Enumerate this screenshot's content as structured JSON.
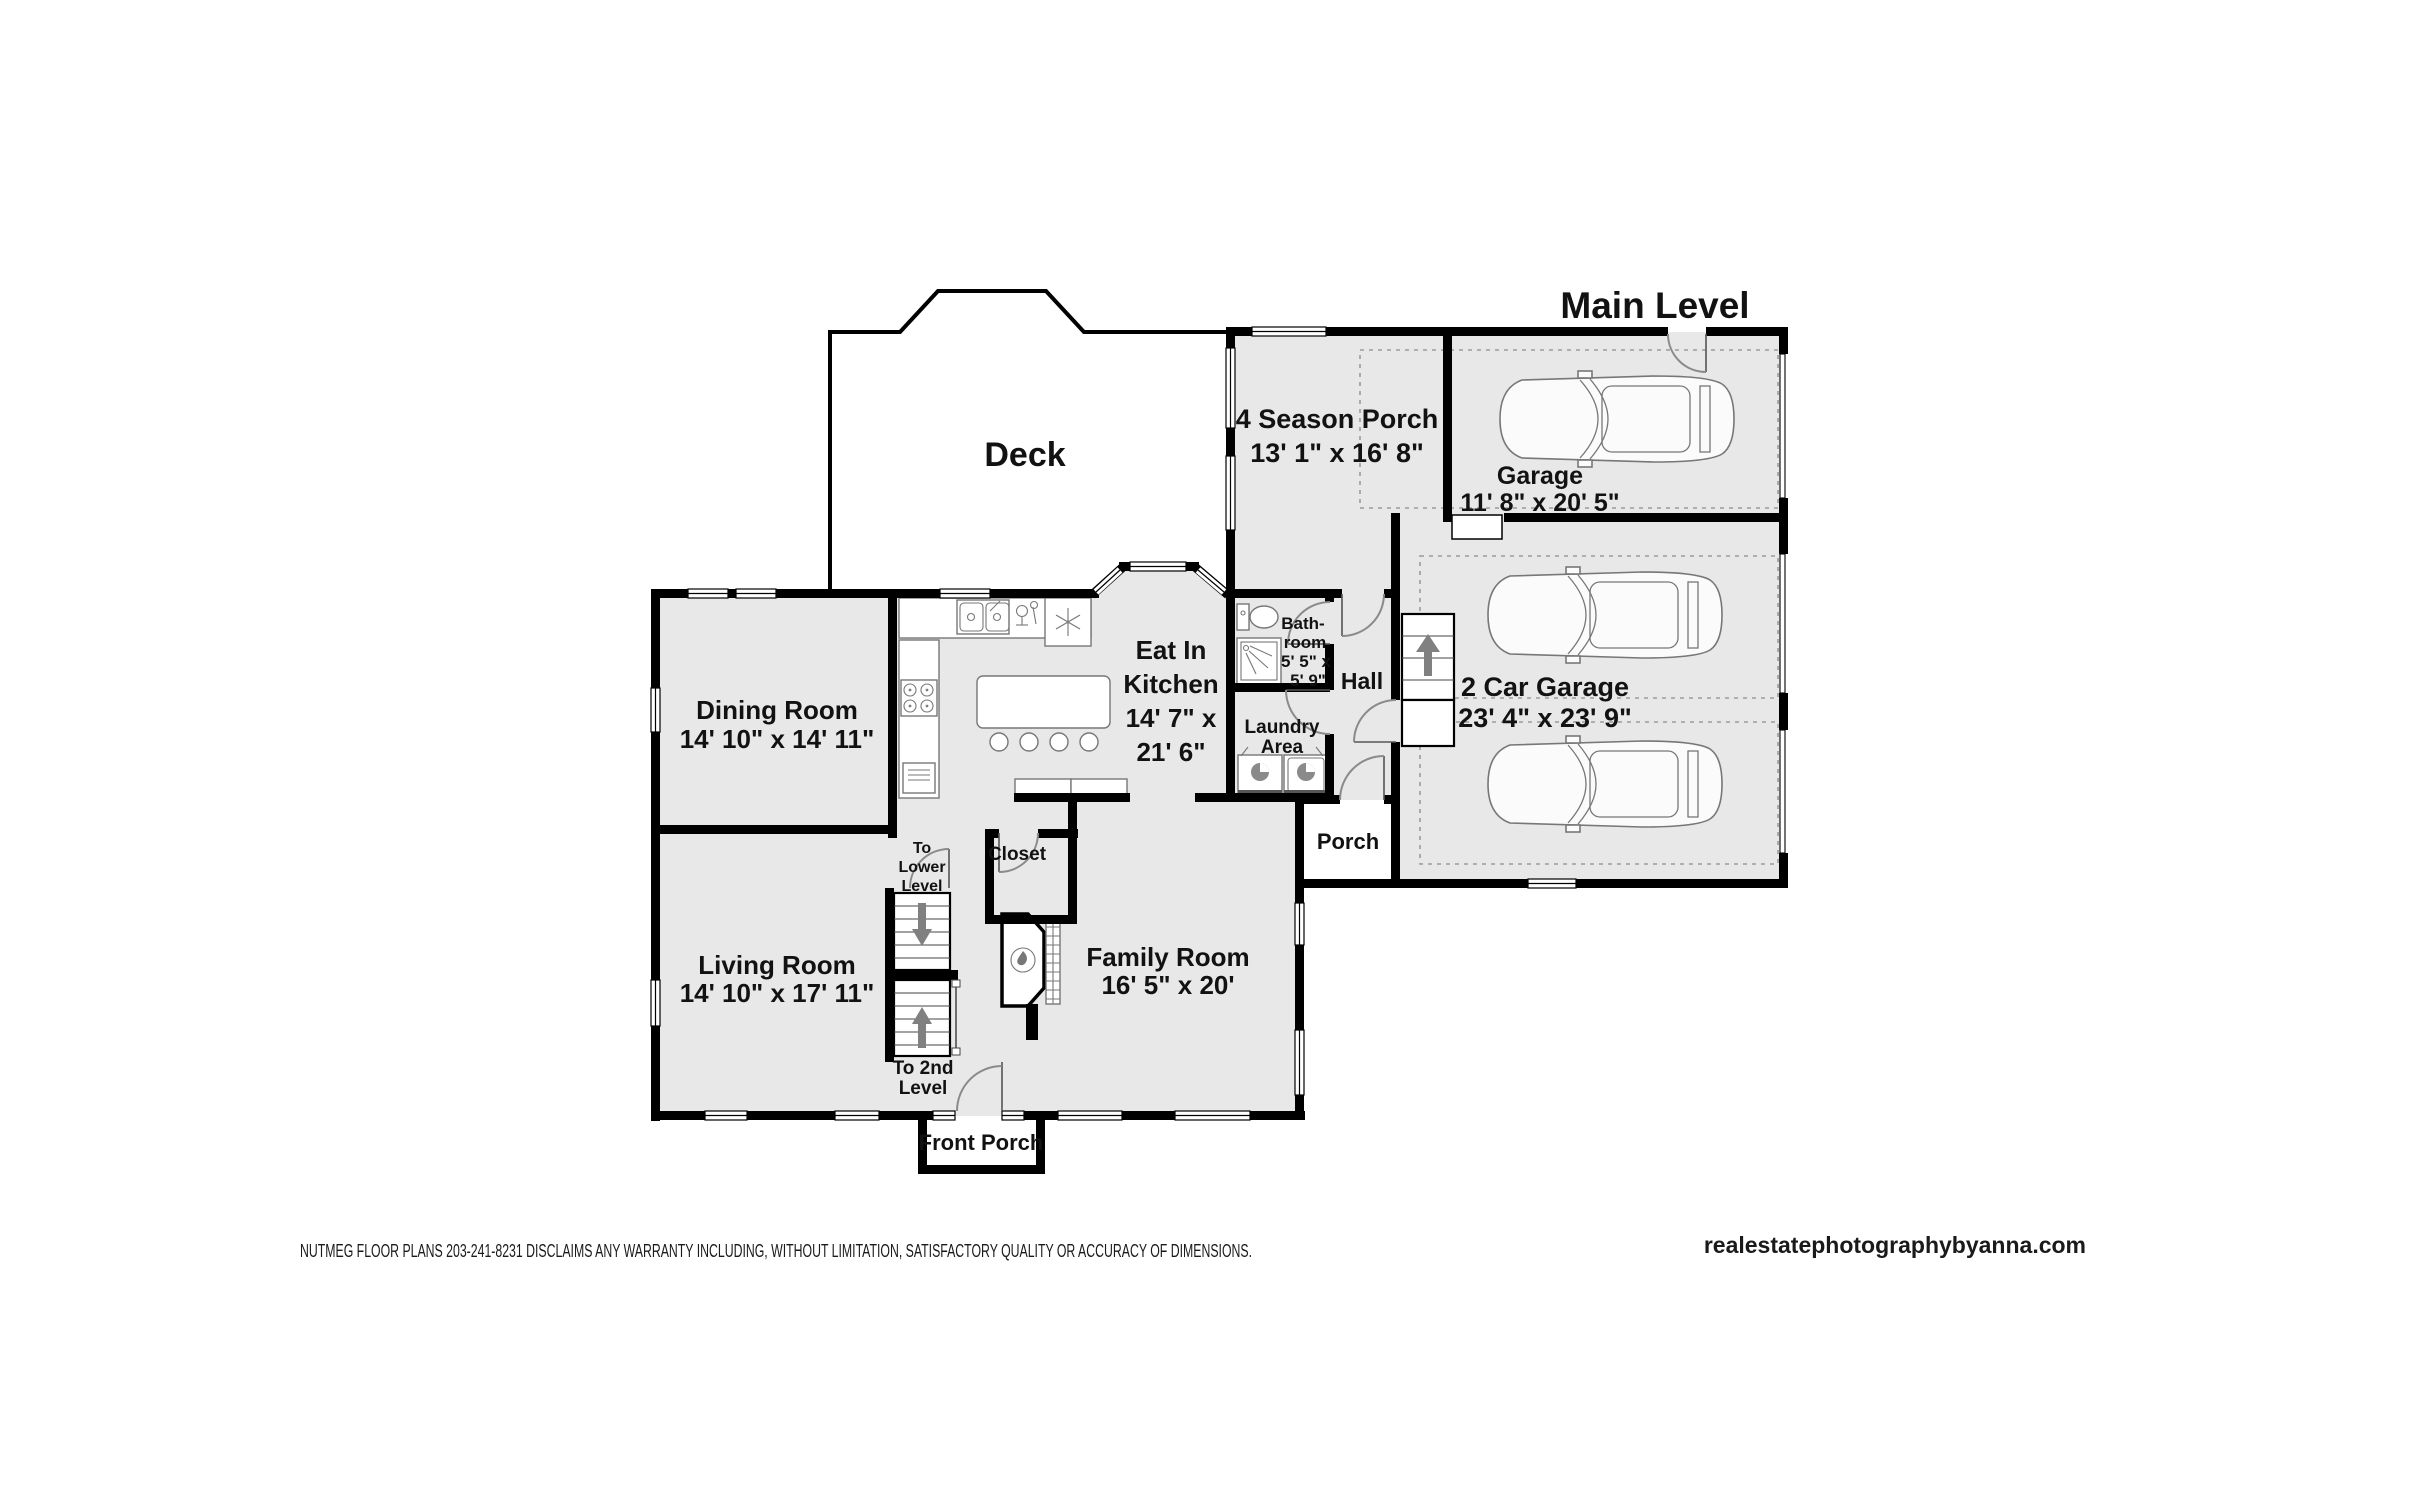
{
  "title": "Main Level",
  "rooms": {
    "deck": {
      "lines": [
        "Deck"
      ]
    },
    "four_season_porch": {
      "lines": [
        "4 Season Porch",
        "13' 1\" x 16' 8\""
      ]
    },
    "garage": {
      "lines": [
        "Garage",
        "11' 8\" x 20' 5\""
      ]
    },
    "two_car_garage": {
      "lines": [
        "2 Car Garage",
        "23' 4\" x 23' 9\""
      ]
    },
    "kitchen": {
      "lines": [
        "Eat In",
        "Kitchen",
        "14' 7\" x",
        "21' 6\""
      ]
    },
    "dining": {
      "lines": [
        "Dining Room",
        "14' 10\" x 14' 11\""
      ]
    },
    "bathroom": {
      "lines": [
        "Bath-",
        "room",
        "5' 5\" x",
        "5' 9\""
      ]
    },
    "hall": {
      "lines": [
        "Hall"
      ]
    },
    "laundry": {
      "lines": [
        "Laundry",
        "Area"
      ]
    },
    "porch": {
      "lines": [
        "Porch"
      ]
    },
    "closet": {
      "lines": [
        "Closet"
      ]
    },
    "family": {
      "lines": [
        "Family Room",
        "16' 5\" x 20'"
      ]
    },
    "living": {
      "lines": [
        "Living Room",
        "14' 10\" x 17' 11\""
      ]
    },
    "front_porch": {
      "lines": [
        "Front Porch"
      ]
    },
    "stairs_down": {
      "lines": [
        "To",
        "Lower",
        "Level"
      ]
    },
    "stairs_up": {
      "lines": [
        "To 2nd",
        "Level"
      ]
    }
  },
  "footer": {
    "disclaimer": "NUTMEG FLOOR PLANS 203-241-8231 DISCLAIMS ANY WARRANTY INCLUDING, WITHOUT LIMITATION, SATISFACTORY QUALITY OR ACCURACY OF DIMENSIONS.",
    "website": "realestatephotographybyanna.com"
  },
  "colors": {
    "room_fill": "#e8e8e8",
    "wall": "#000000",
    "door_arc": "#8a8a8a"
  }
}
